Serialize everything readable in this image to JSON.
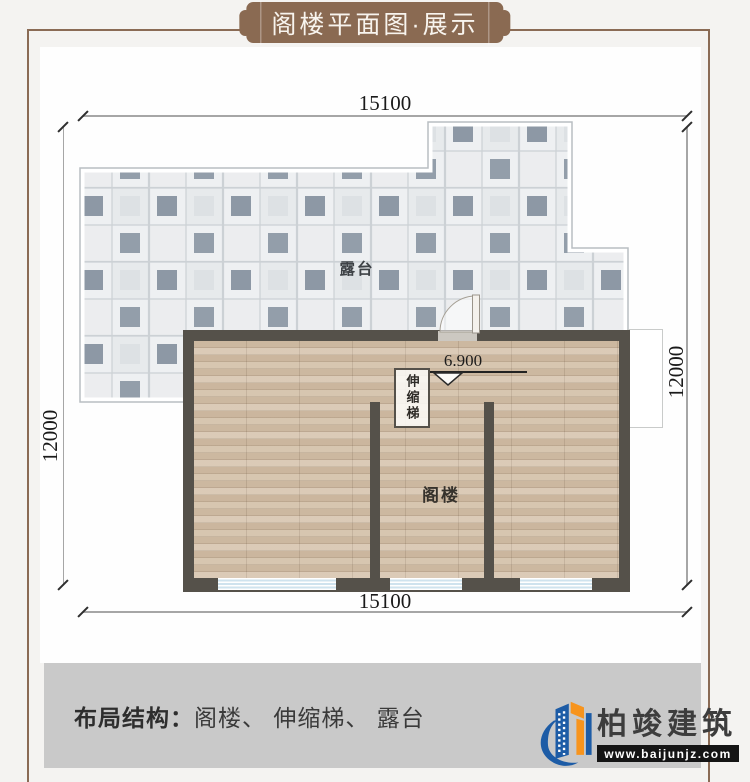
{
  "banner": {
    "title": "阁楼平面图·展示"
  },
  "plan": {
    "dim_top": "15100",
    "dim_bottom": "15100",
    "dim_left": "12000",
    "dim_right": "12000",
    "terrace_label": "露台",
    "attic_label": "阁楼",
    "ladder_label": "伸缩梯",
    "level_label": "6.900"
  },
  "footer": {
    "label": "布局结构：",
    "value": "阁楼、 伸缩梯、 露台"
  },
  "logo": {
    "brand": "柏竣建筑",
    "website": "www.baijunjz.com"
  },
  "colors": {
    "banner_brown": "#8a6a52",
    "frame_brown": "#8a6b55",
    "wall_dark": "#55514a",
    "wood_floor": "#d5c2ab",
    "tile_light": "#eef0f2",
    "tile_dark": "#8d98a5",
    "window_blue": "#cfe3ee",
    "footer_grey": "#c9c9c9",
    "logo_blue": "#1d5ca6",
    "logo_orange": "#f7941d"
  }
}
